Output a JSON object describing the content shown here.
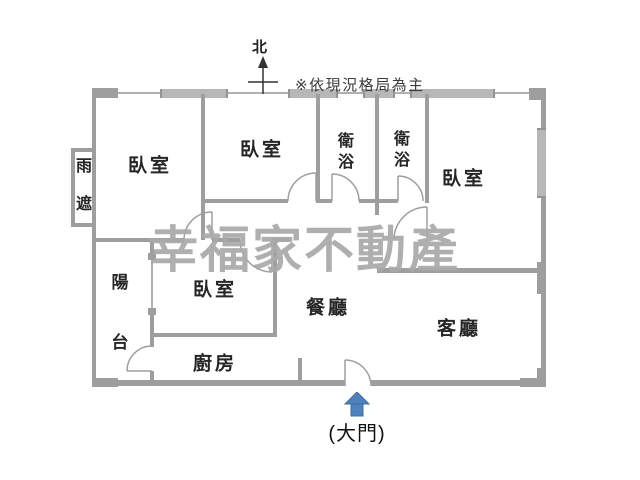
{
  "compass": {
    "north_label": "北"
  },
  "disclaimer": "※依現況格局為主",
  "watermark": "幸福家不動產",
  "rooms": {
    "rain_shield": "雨遮",
    "bedroom_top_left": "臥室",
    "bedroom_top_mid": "臥室",
    "bathroom_left": "衛浴",
    "bathroom_right": "衛浴",
    "bedroom_right": "臥室",
    "balcony": "陽台",
    "bedroom_lower": "臥室",
    "kitchen": "廚房",
    "dining": "餐廳",
    "living": "客廳"
  },
  "entrance": {
    "label": "(大門)"
  },
  "colors": {
    "wall": "#9e9e9e",
    "window": "#b7b7b7",
    "watermark": "#a9a9a9",
    "arrow": "#4f81bd",
    "label": "#262626"
  }
}
